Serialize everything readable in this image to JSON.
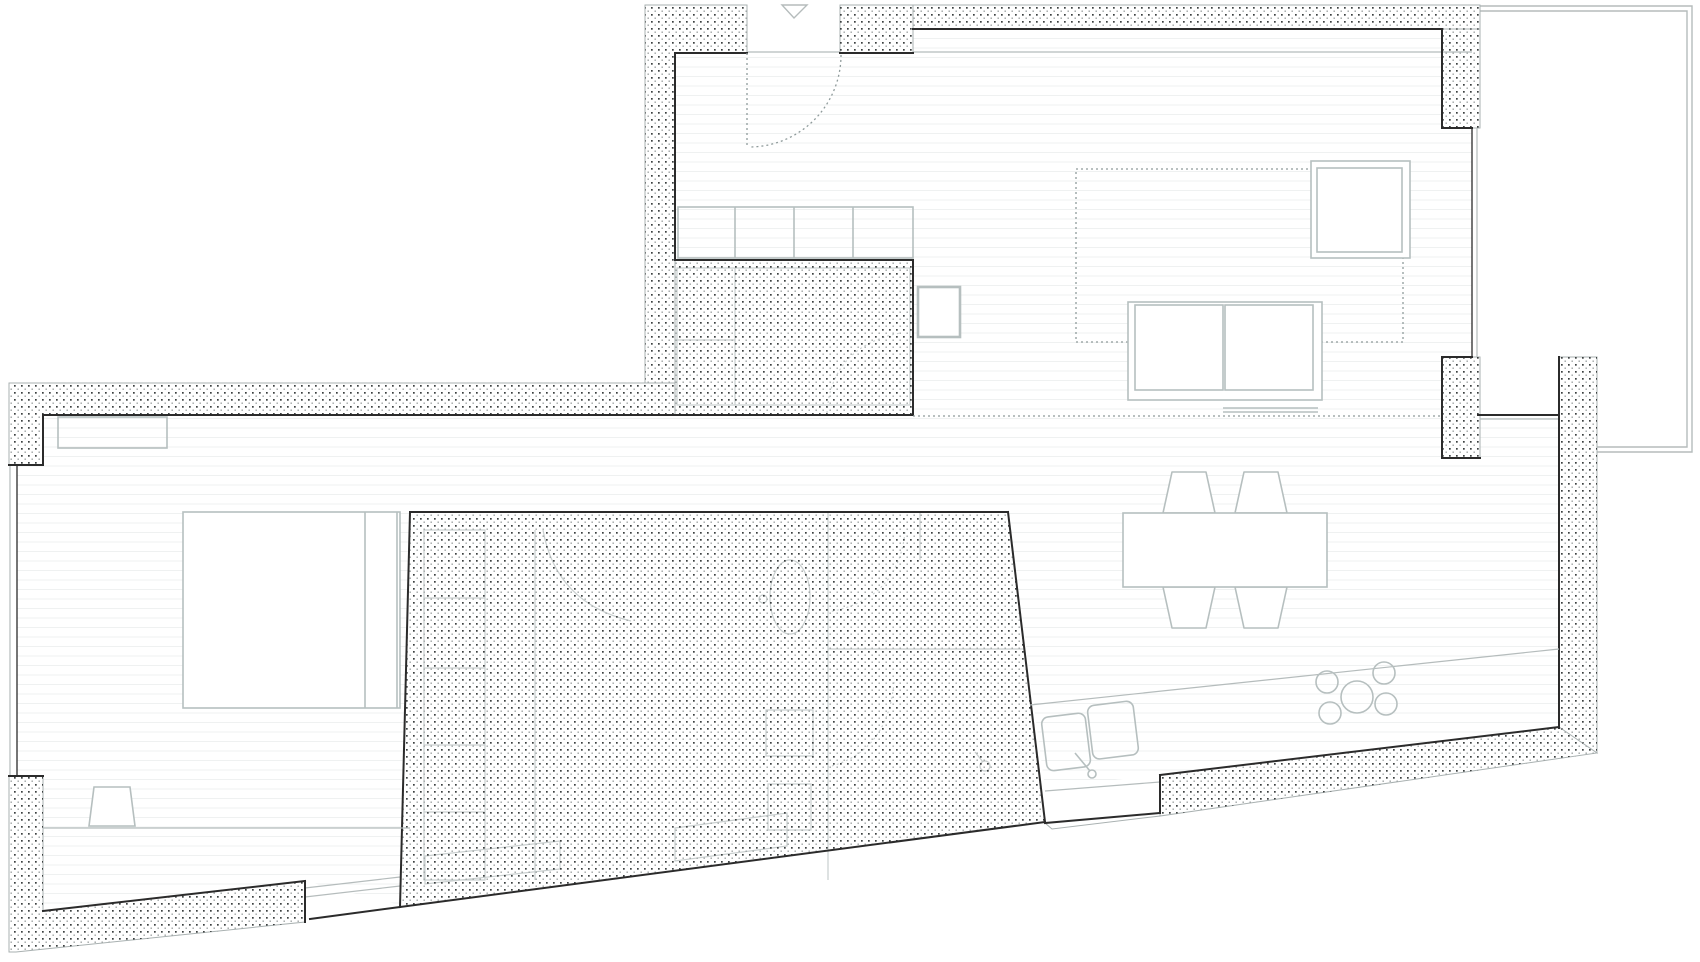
{
  "meta": {
    "type": "architectural-floor-plan",
    "view": "top-down plan of an apartment",
    "canvas": {
      "width": 1700,
      "height": 962
    },
    "visible_text": "none"
  },
  "palette": {
    "wall-dark": "#2b2b2b",
    "wall-outline": "#a9b1b1",
    "line-light": "#b5bcbc",
    "furniture": "#b6bfbf",
    "faint": "#c9cfcf",
    "dotted": "#8f9b9b",
    "stipple-dot-dark": "#3c4040",
    "stipple-dot-light": "#9aa0a0",
    "floor-line": "#eff1f1",
    "background": "#ffffff"
  },
  "inventory": {
    "entrance": {
      "door_swing": 1,
      "entry_marker_triangle": 1,
      "cabinet_sections": 4
    },
    "living_room": {
      "rug": 1,
      "armchair": 1,
      "sofa_seats": 2,
      "side_table": 1
    },
    "dining": {
      "table": 1,
      "chairs": 4
    },
    "kitchen": {
      "sink_bowls": 2,
      "faucet": 1,
      "cooktop_burners": 5,
      "counter": 1
    },
    "bedroom": {
      "bed": 1,
      "desk": 1,
      "stool": 1,
      "closet": 1,
      "window_bands": 2
    },
    "service_core": {
      "wardrobe_cells": 5,
      "toilet": 1,
      "wash_basins": 2,
      "door_arcs": 4
    },
    "exterior": {
      "terrace": 1
    }
  }
}
